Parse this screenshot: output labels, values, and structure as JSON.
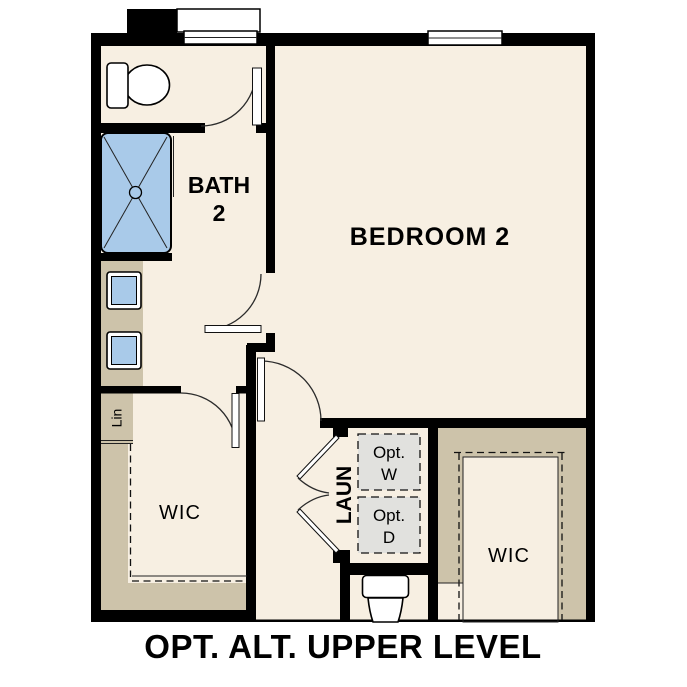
{
  "title": "OPT. ALT. UPPER LEVEL",
  "labels": {
    "bath_line1": "BATH",
    "bath_line2": "2",
    "bedroom": "BEDROOM 2",
    "wic_left": "WIC",
    "wic_right": "WIC",
    "linen": "Lin",
    "laundry": "LAUN",
    "opt_washer_line1": "Opt.",
    "opt_washer_line2": "W",
    "opt_dryer_line1": "Opt.",
    "opt_dryer_line2": "D"
  },
  "colors": {
    "wall": "#000000",
    "floor": "#f7efe2",
    "casework_tan": "#cdc3aa",
    "fixture_blue": "#a9cae9",
    "appliance_gray": "#e1e1de",
    "door_line": "#2b2b2b",
    "background": "#ffffff"
  }
}
